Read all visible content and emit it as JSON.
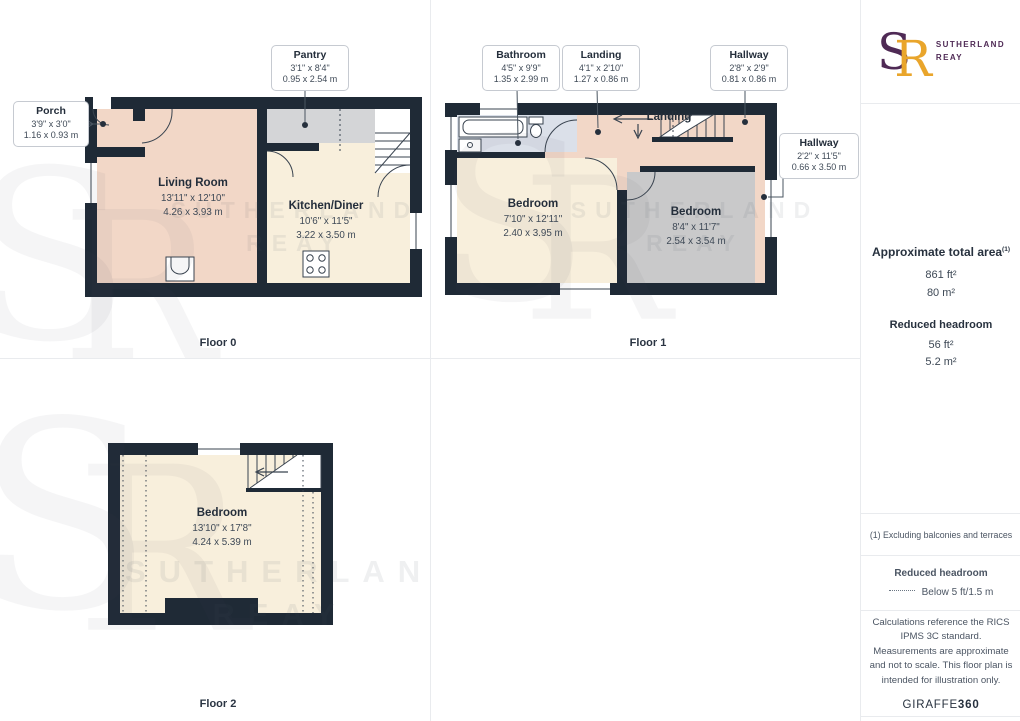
{
  "brand": {
    "logo_s": "S",
    "logo_r": "R",
    "name_top": "SUTHERLAND",
    "name_bottom": "REAY",
    "purple": "#4f2a55",
    "gold": "#e9a52b"
  },
  "watermark": {
    "mono_s": "S",
    "mono_r": "R",
    "line1": "SUTHERLAND",
    "line2": "REAY"
  },
  "floor0": {
    "caption": "Floor 0",
    "living_room": {
      "name": "Living Room",
      "imperial": "13'11\" x 12'10\"",
      "metric": "4.26 x 3.93 m"
    },
    "kitchen": {
      "name": "Kitchen/Diner",
      "imperial": "10'6\" x 11'5\"",
      "metric": "3.22 x 3.50 m"
    },
    "porch": {
      "name": "Porch",
      "imperial": "3'9\" x 3'0\"",
      "metric": "1.16 x 0.93 m"
    },
    "pantry": {
      "name": "Pantry",
      "imperial": "3'1\" x 8'4\"",
      "metric": "0.95 x 2.54 m"
    }
  },
  "floor1": {
    "caption": "Floor 1",
    "bathroom": {
      "name": "Bathroom",
      "imperial": "4'5\" x 9'9\"",
      "metric": "1.35 x 2.99 m"
    },
    "landing": {
      "name": "Landing",
      "imperial": "4'1\" x 2'10\"",
      "metric": "1.27 x 0.86 m"
    },
    "hallway_top": {
      "name": "Hallway",
      "imperial": "2'8\" x 2'9\"",
      "metric": "0.81 x 0.86 m"
    },
    "hallway_right": {
      "name": "Hallway",
      "imperial": "2'2\" x 11'5\"",
      "metric": "0.66 x 3.50 m"
    },
    "bedroom_left": {
      "name": "Bedroom",
      "imperial": "7'10\" x 12'11\"",
      "metric": "2.40 x 3.95 m"
    },
    "bedroom_right": {
      "name": "Bedroom",
      "imperial": "8'4\" x 11'7\"",
      "metric": "2.54 x 3.54 m"
    },
    "landing_label": "Landing"
  },
  "floor2": {
    "caption": "Floor 2",
    "bedroom": {
      "name": "Bedroom",
      "imperial": "13'10\" x 17'8\"",
      "metric": "4.24 x 5.39 m"
    }
  },
  "sidebar": {
    "area_title": "Approximate total area",
    "area_sup": "(1)",
    "area_ft": "861 ft²",
    "area_m": "80 m²",
    "reduced_title": "Reduced headroom",
    "reduced_ft": "56 ft²",
    "reduced_m": "5.2 m²",
    "footnote": "(1) Excluding balconies and terraces",
    "legend_title": "Reduced headroom",
    "legend_value": "Below 5 ft/1.5 m",
    "disclaimer": "Calculations reference the RICS IPMS 3C standard. Measurements are approximate and not to scale. This floor plan is intended for illustration only.",
    "maker_name": "GIRAFFE",
    "maker_suffix": "360"
  }
}
